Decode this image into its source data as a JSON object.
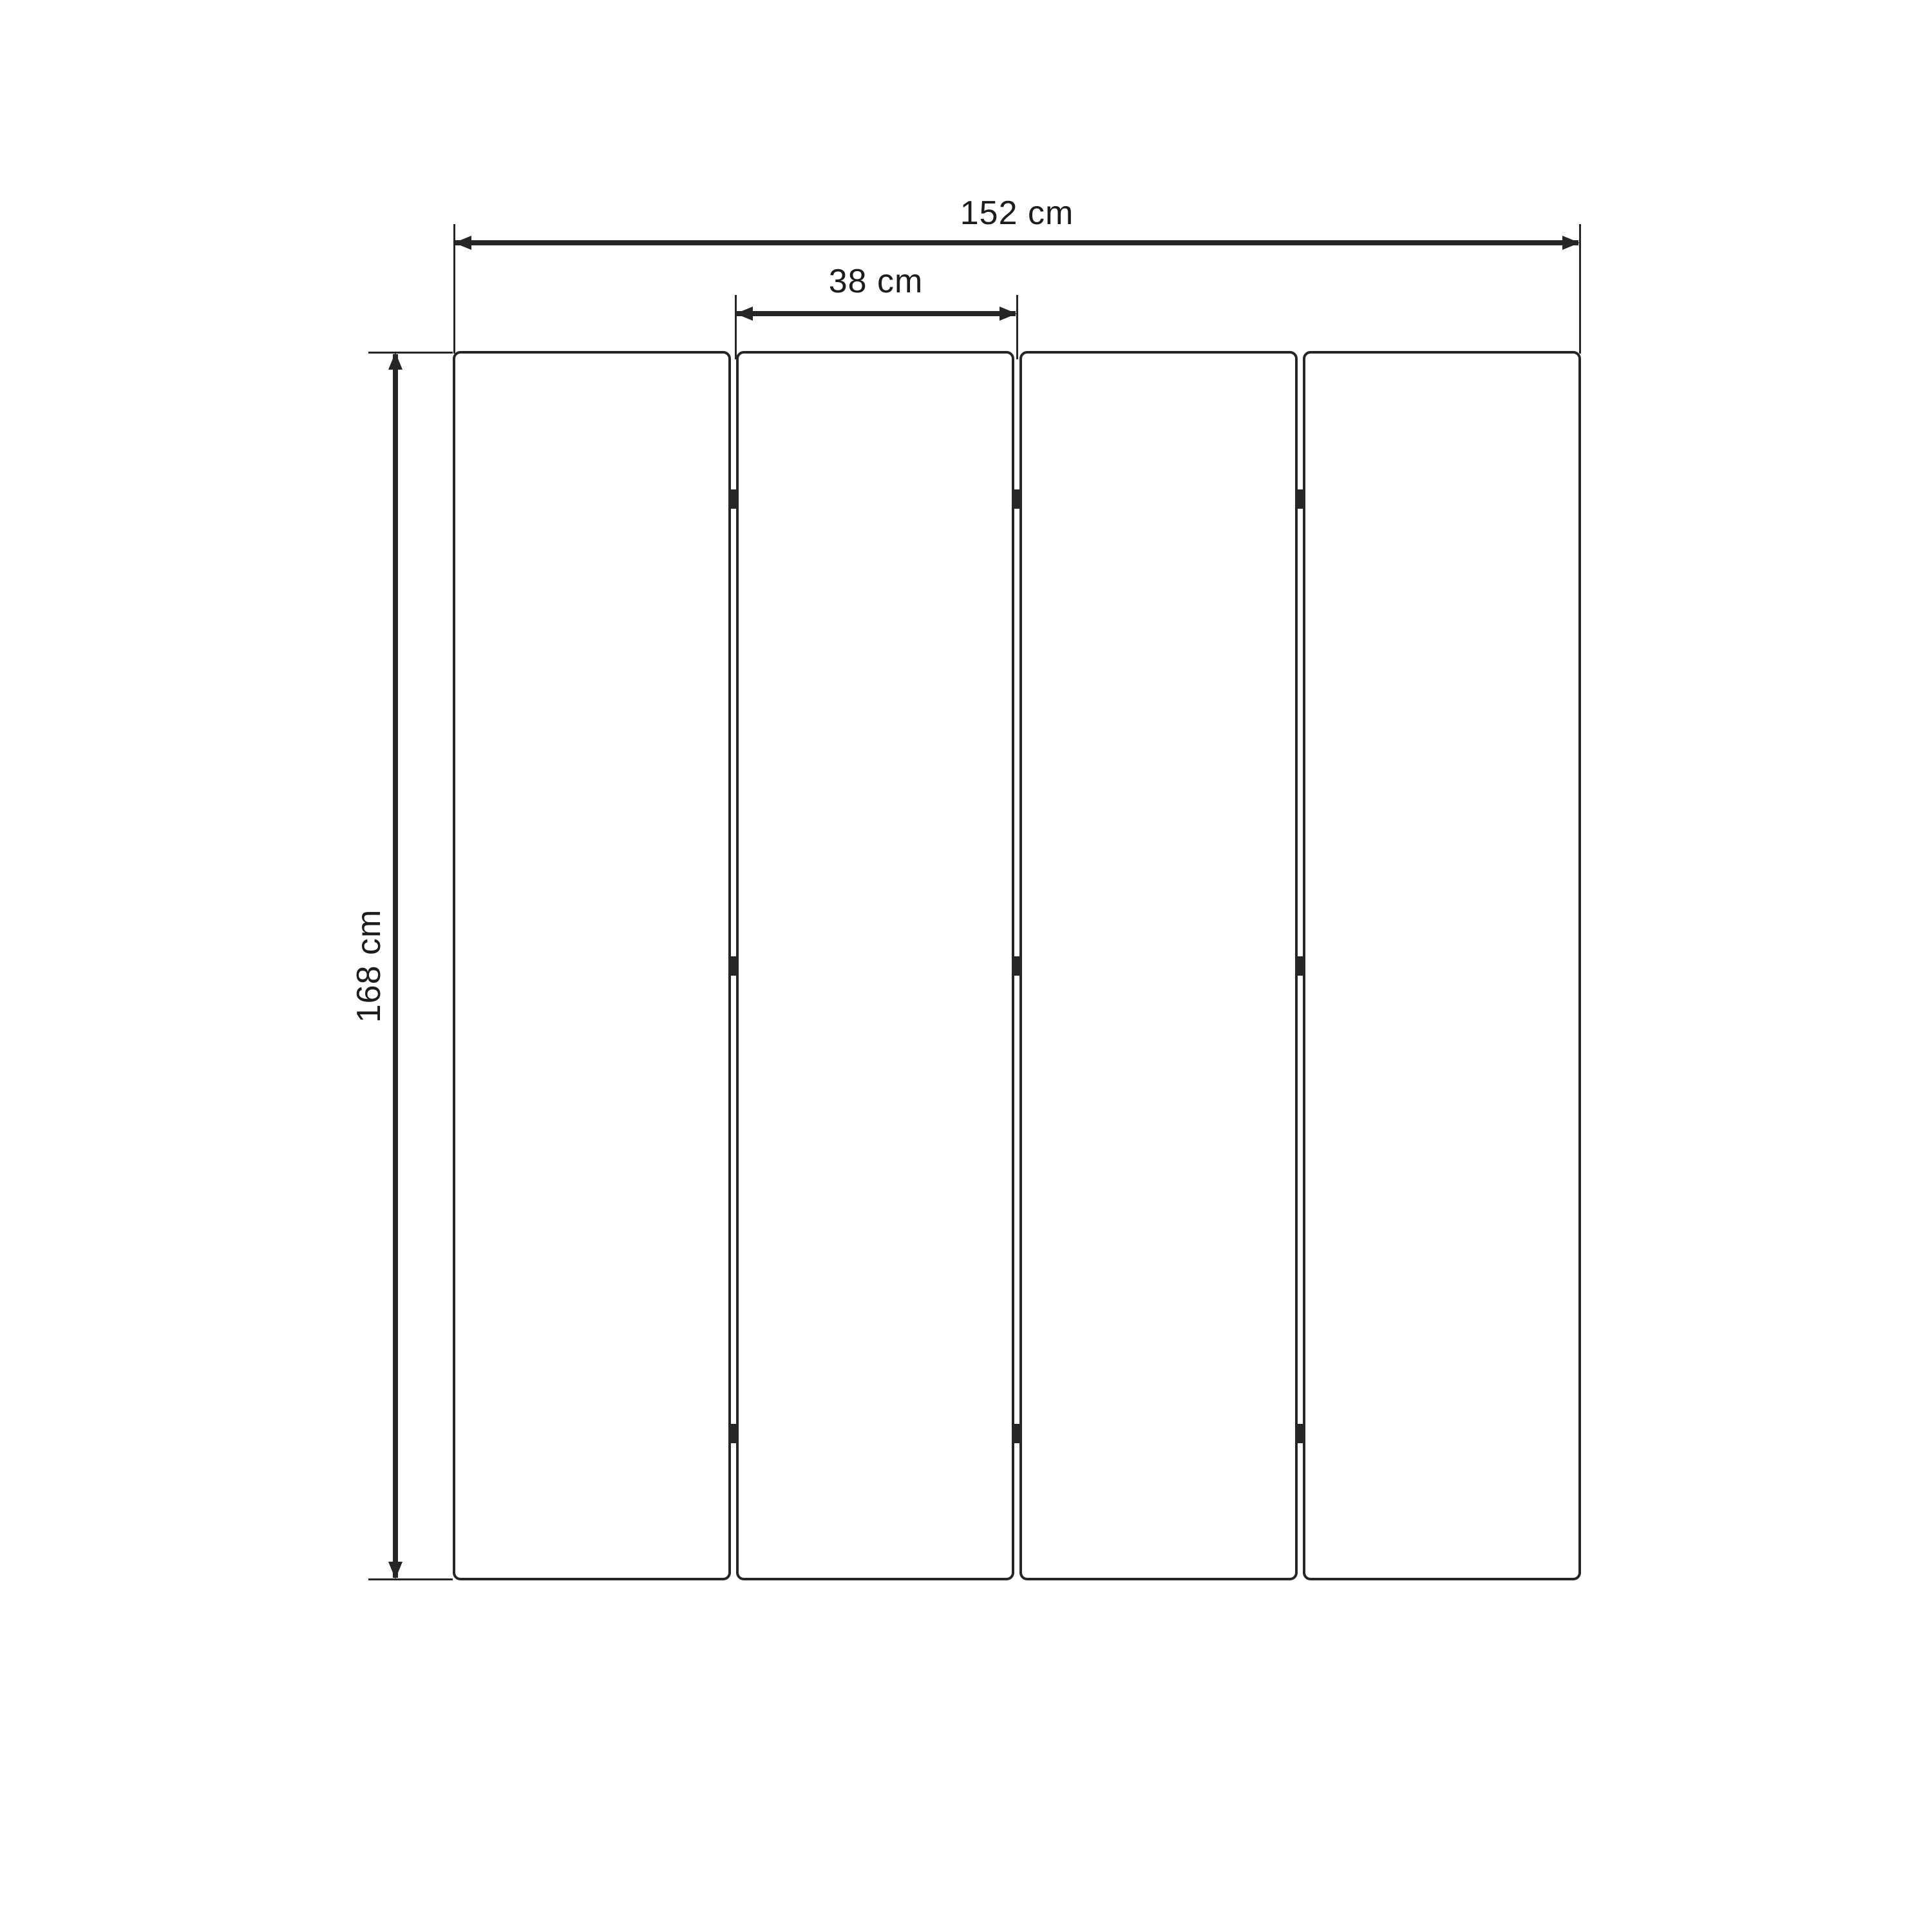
{
  "figure": {
    "description": "Front-view dimension diagram of a four-panel folding screen room divider",
    "panel_count": 4,
    "gap_count": 3,
    "hinges_per_gap": 3,
    "dimensions": {
      "total_width": {
        "label": "152 cm",
        "value": 152,
        "unit": "cm"
      },
      "panel_width": {
        "label": "38 cm",
        "value": 38,
        "unit": "cm"
      },
      "height": {
        "label": "168 cm",
        "value": 168,
        "unit": "cm"
      }
    },
    "colors": {
      "line": "#262626",
      "background": "#ffffff"
    }
  }
}
